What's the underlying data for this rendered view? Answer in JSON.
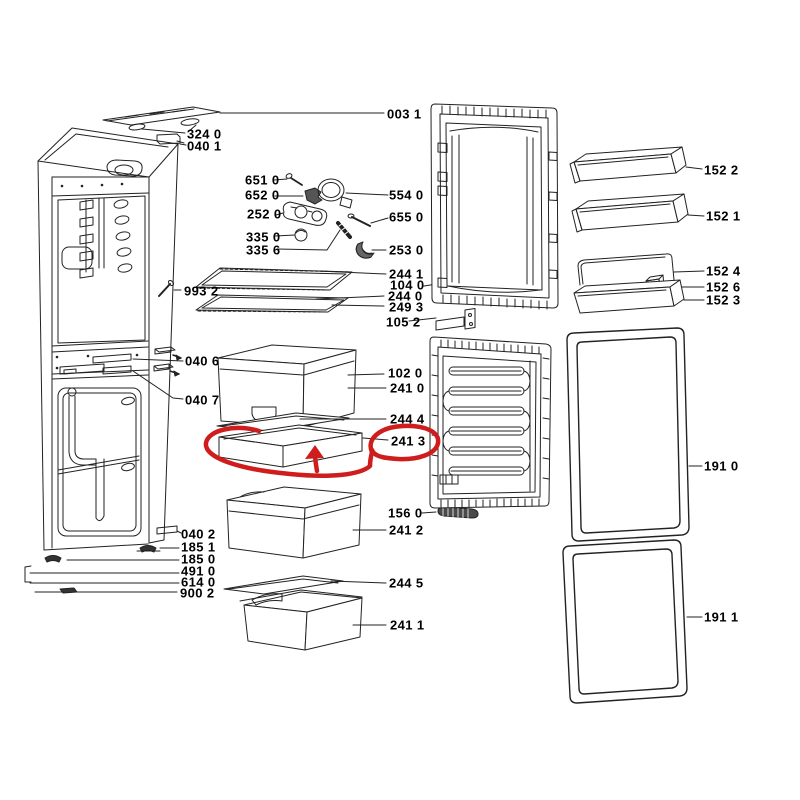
{
  "diagram": {
    "type": "exploded-parts-diagram",
    "subject": "fridge-freezer spare parts schematic",
    "background_color": "#ffffff",
    "line_color": "#222222",
    "label_color": "#000000",
    "annotation_color": "#cf1d1d",
    "highlighted_part": "241 3",
    "annotation_shapes": "hand-drawn red loop around shallow drawer, red oval around label 241 3, red up arrow"
  },
  "parts": {
    "p003_1": "003 1",
    "p324_0": "324 0",
    "p040_1": "040 1",
    "p651_0": "651 0",
    "p652_0": "652 0",
    "p252_0": "252 0",
    "p335_0": "335 0",
    "p335_6": "335 6",
    "p554_0": "554 0",
    "p655_0": "655 0",
    "p253_0": "253 0",
    "p244_1": "244 1",
    "p104_0": "104 0",
    "p244_0": "244 0",
    "p249_3": "249 3",
    "p105_2": "105 2",
    "p993_2": "993 2",
    "p040_6": "040 6",
    "p040_7": "040 7",
    "p102_0": "102 0",
    "p241_0": "241 0",
    "p244_4": "244 4",
    "p241_3": "241 3",
    "p156_0": "156 0",
    "p241_2": "241 2",
    "p040_2": "040 2",
    "p185_1": "185 1",
    "p185_0": "185 0",
    "p491_0": "491 0",
    "p614_0": "614 0",
    "p900_2": "900 2",
    "p244_5": "244 5",
    "p241_1": "241 1",
    "p152_2": "152 2",
    "p152_1": "152 1",
    "p152_4": "152 4",
    "p152_6": "152 6",
    "p152_3": "152 3",
    "p191_0": "191 0",
    "p191_1": "191 1"
  }
}
